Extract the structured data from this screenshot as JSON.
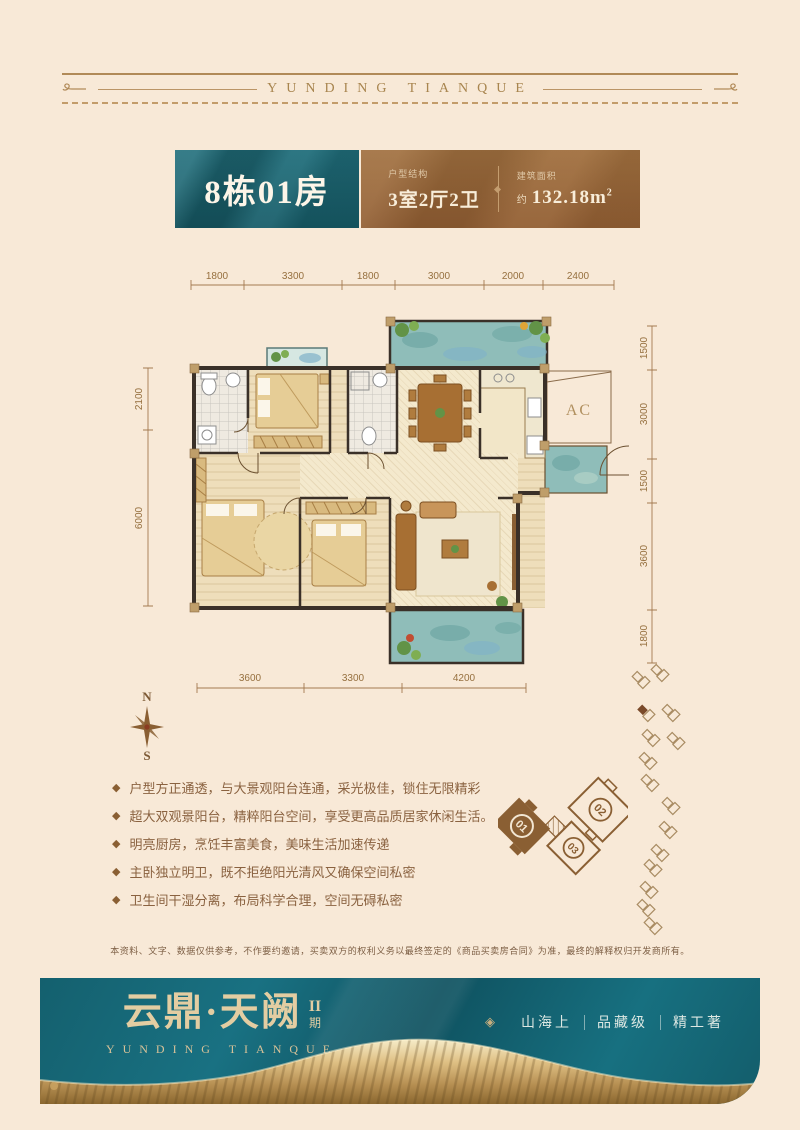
{
  "page": {
    "background": "#f8e9d7"
  },
  "masthead": {
    "title": "YUNDING TIANQUE"
  },
  "header": {
    "unit_title": "8栋01房",
    "layout_label": "户型结构",
    "layout_value": "3室2厅2卫",
    "area_label": "建筑面积",
    "area_prefix": "约",
    "area_value": "132.18m",
    "area_sup": "2"
  },
  "floorplan": {
    "ac_label": "AC",
    "compass_n": "N",
    "compass_s": "S",
    "dims_top": [
      "1800",
      "3300",
      "1800",
      "3000",
      "2000",
      "2400"
    ],
    "dims_left": [
      "2100",
      "6000"
    ],
    "dims_right": [
      "1500",
      "3000",
      "1500",
      "3600",
      "1800"
    ],
    "dims_bottom": [
      "3600",
      "3300",
      "4200"
    ],
    "site_units": {
      "u01": "01",
      "u02": "02",
      "u03": "03"
    }
  },
  "features": {
    "bullet": "◆",
    "items": [
      "户型方正通透，与大景观阳台连通，采光极佳，锁住无限精彩",
      "超大双观景阳台，精粹阳台空间，享受更高品质居家休闲生活。",
      "明亮厨房，烹饪丰富美食，美味生活加速传递",
      "主卧独立明卫，既不拒绝阳光清风又确保空间私密",
      "卫生间干湿分离，布局科学合理，空间无碍私密"
    ]
  },
  "disclaimer": "本资料、文字、数据仅供参考，不作要约邀请，买卖双方的权利义务以最终签定的《商品买卖房合同》为准，最终的解释权归开发商所有。",
  "footer": {
    "logo_cn": "云鼎·天阙",
    "phase_top": "II",
    "phase_bottom": "期",
    "logo_en": "YUNDING TIANQUE",
    "diamond_icon": "◈",
    "slogans": [
      "山海上",
      "品藏级",
      "精工著"
    ]
  },
  "colors": {
    "accent_teal": "#1d6b78",
    "accent_brown": "#9a6a3c",
    "footer_teal": "#15616f",
    "gold": "#c9a260",
    "logo_gold": "#e3cda2",
    "dim_line": "#a37a50",
    "feature_text": "#8a6240"
  }
}
